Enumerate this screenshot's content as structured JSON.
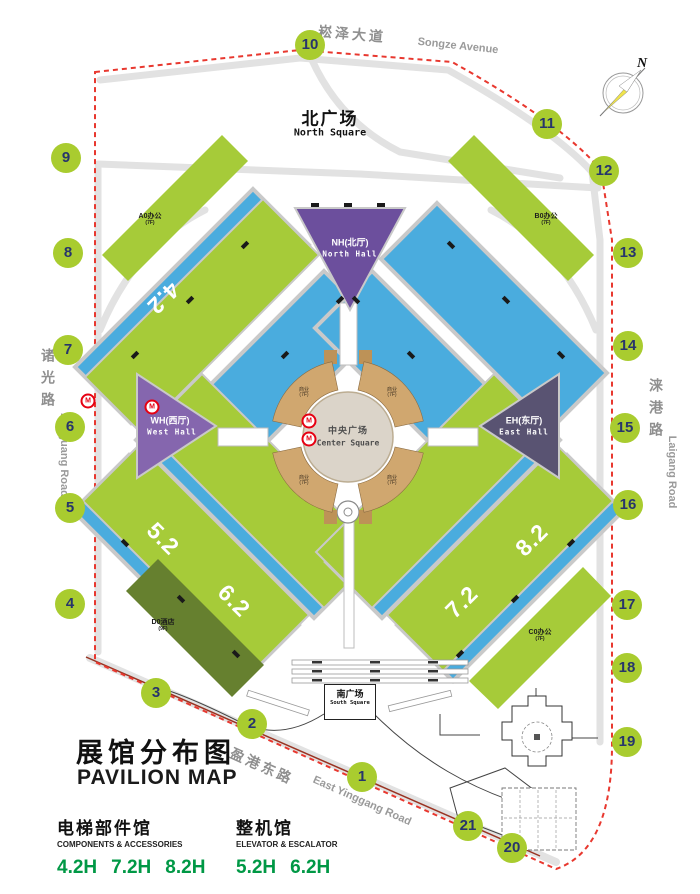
{
  "title": {
    "zh": "展馆分布图",
    "en": "PAVILION MAP"
  },
  "legend": {
    "groups": [
      {
        "zh": "电梯部件馆",
        "en": "COMPONENTS & ACCESSORIES",
        "halls": [
          "4.2H",
          "7.2H",
          "8.2H"
        ]
      },
      {
        "zh": "整机馆",
        "en": "ELEVATOR & ESCALATOR",
        "halls": [
          "5.2H",
          "6.2H"
        ]
      }
    ]
  },
  "roads": {
    "north": {
      "zh": "崧泽大道",
      "en": "Songze Avenue"
    },
    "west": {
      "zh": "诸光路",
      "en": "Zhuguang Road"
    },
    "east": {
      "zh": "涞港路",
      "en": "Laigang Road"
    },
    "south": {
      "zh": "盈港东路",
      "en": "East Yinggang Road"
    }
  },
  "squares": {
    "north": {
      "zh": "北广场",
      "en": "North Square"
    },
    "south": {
      "zh": "南广场",
      "en": "South Square"
    },
    "center": {
      "zh": "中央广场",
      "en": "Center Square"
    }
  },
  "halls": {
    "north": {
      "code": "NH(北厅)",
      "en": "North Hall"
    },
    "west": {
      "code": "WH(西厅)",
      "en": "West Hall"
    },
    "east": {
      "code": "EH(东厅)",
      "en": "East Hall"
    },
    "numbered": [
      "4.2",
      "5.2",
      "6.2",
      "7.2",
      "8.2"
    ]
  },
  "buildings": {
    "a0": {
      "label": "A0办公",
      "floors": "(7F)"
    },
    "b0": {
      "label": "B0办公",
      "floors": "(7F)"
    },
    "c0": {
      "label": "C0办公",
      "floors": "(7F)"
    },
    "d0": {
      "label": "D0酒店",
      "floors": "(9F)"
    },
    "commercial": {
      "label": "商业",
      "floors": "(7F)"
    }
  },
  "gates": [
    "1",
    "2",
    "3",
    "4",
    "5",
    "6",
    "7",
    "8",
    "9",
    "10",
    "11",
    "12",
    "13",
    "14",
    "15",
    "16",
    "17",
    "18",
    "19",
    "20",
    "21"
  ],
  "compass": {
    "label": "N"
  },
  "metro_icon": "M",
  "colors": {
    "hall_blue": "#4aacde",
    "hall_green": "#a6cb39",
    "gate_green": "#a9cc2f",
    "north_hall_purple": "#6c4f9d",
    "west_hall_purple": "#8566ae",
    "east_hall_slate": "#595372",
    "center_tan": "#d0a76f",
    "hotel_olive": "#66802f",
    "boundary_red": "#e8382f",
    "legend_green": "#009845",
    "gate_number_navy": "#27356b"
  }
}
